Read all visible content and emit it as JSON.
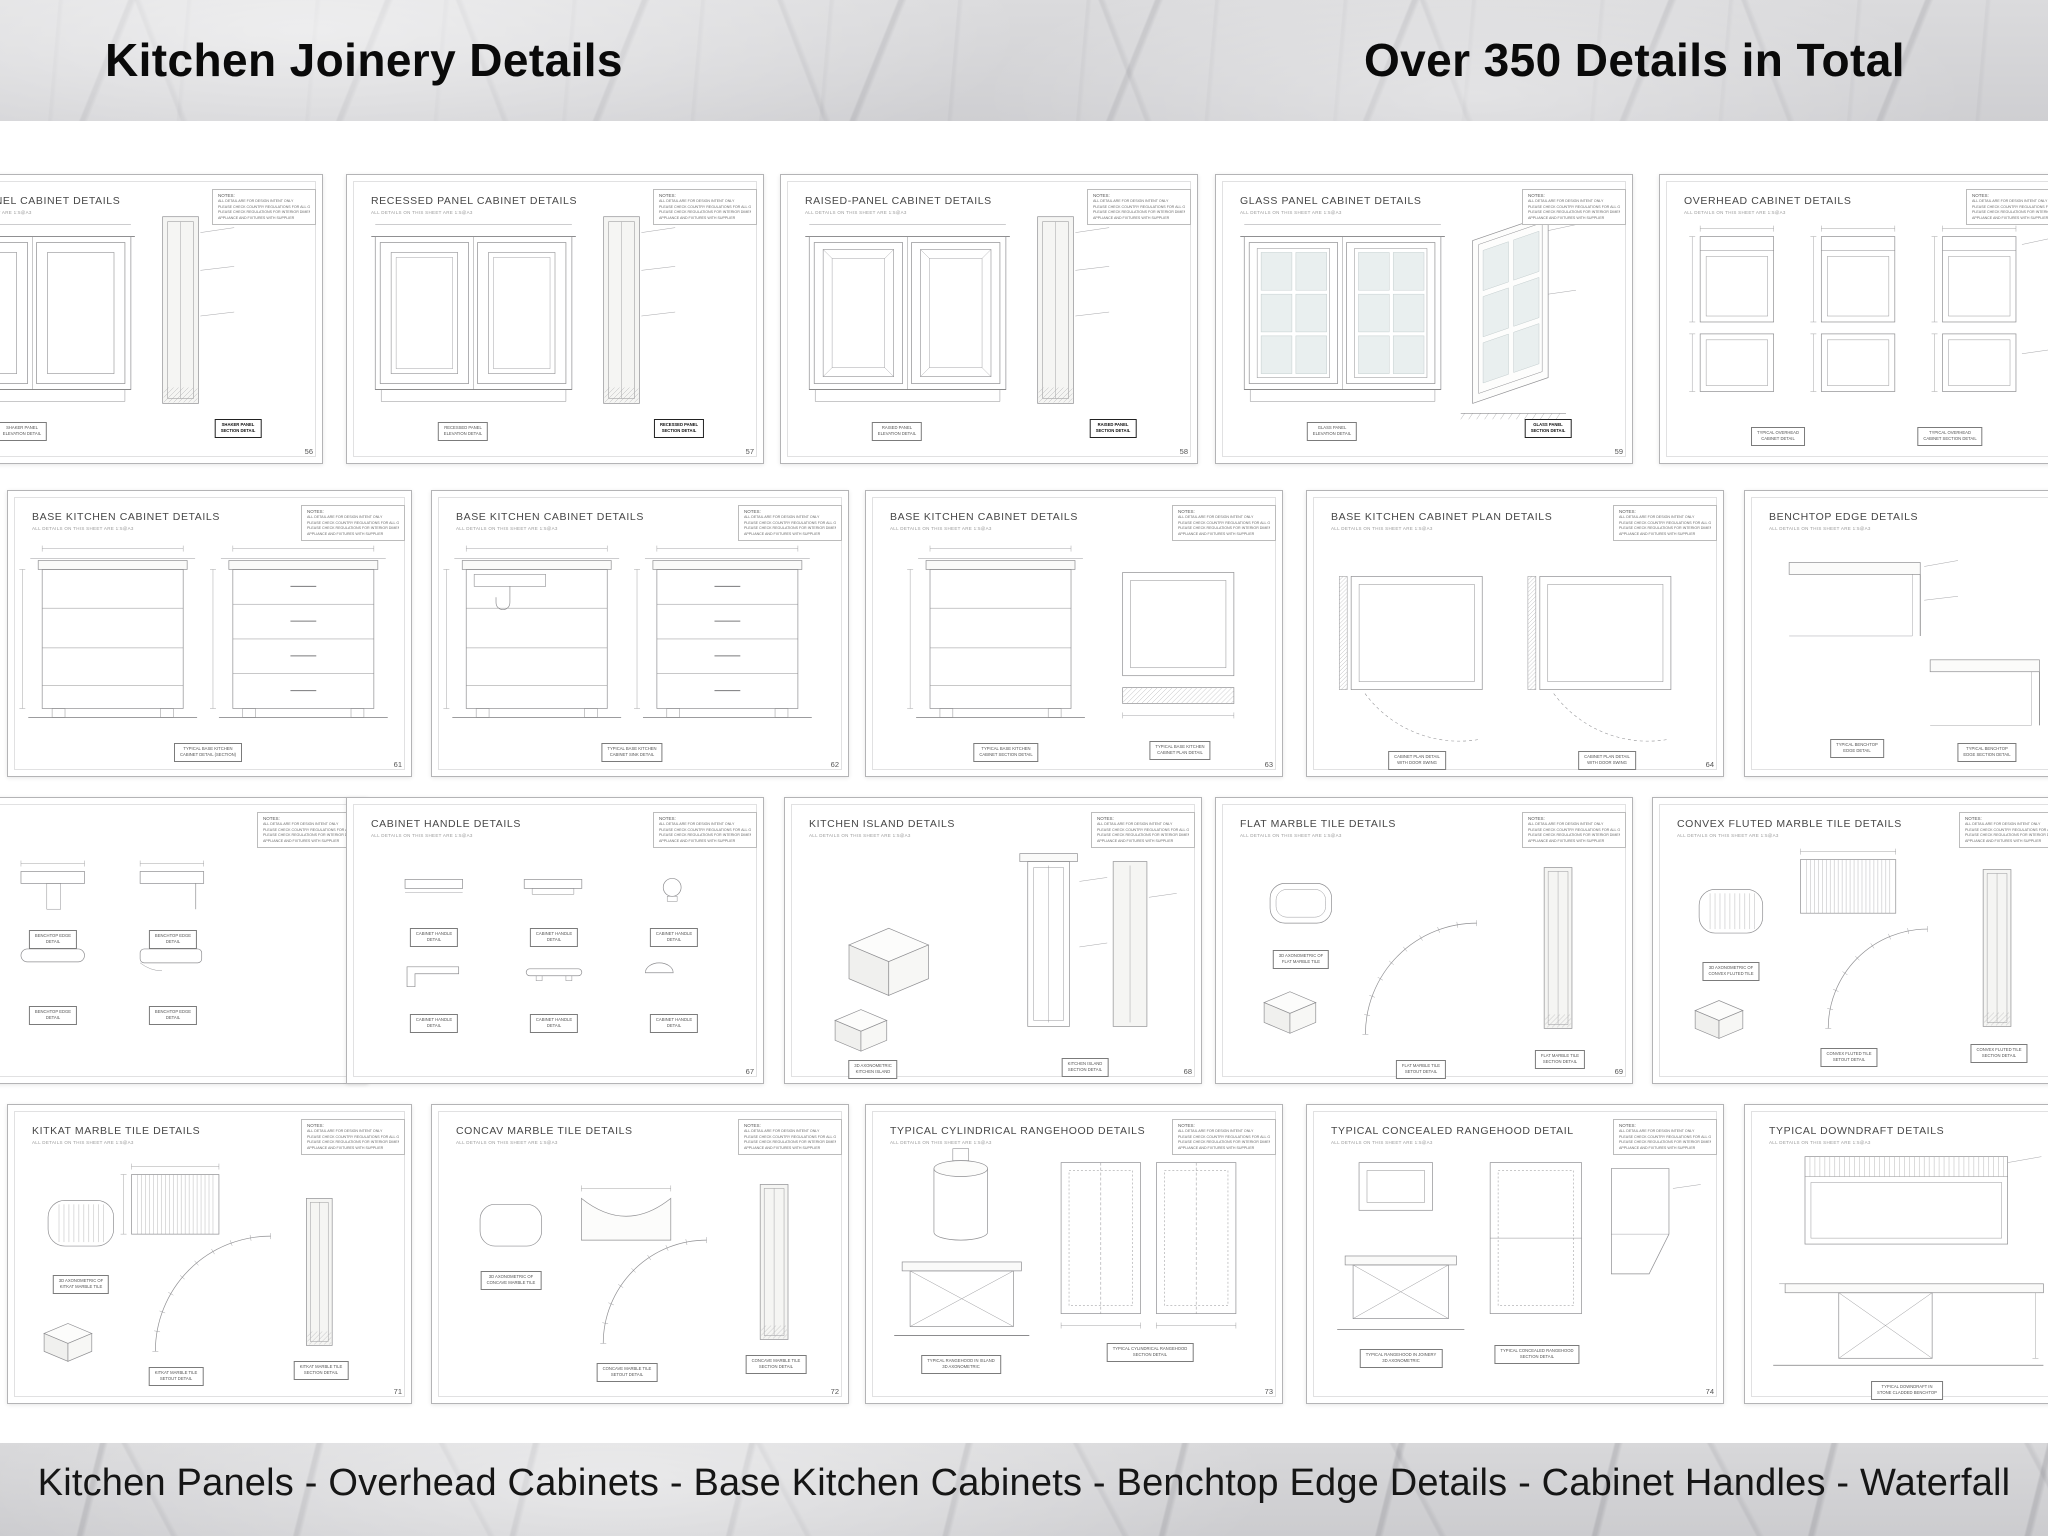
{
  "header": {
    "title_left": "Kitchen Joinery Details",
    "title_right": "Over 350 Details in Total"
  },
  "footer": {
    "caption": "Kitchen Panels - Overhead Cabinets - Base Kitchen Cabinets - Benchtop Edge Details - Cabinet Handles - Waterfall"
  },
  "sheet_common": {
    "subtitle": "ALL DETAILS ON THIS SHEET ARE 1:5@A3",
    "notes_label": "NOTES:",
    "notes_lines": [
      "ALL DETAIL ARE FOR DESIGN INTENT ONLY",
      "PLEASE CHECK COUNTRY REGULATIONS FOR ALL GENERAL BENCHTOP",
      "PLEASE CHECK REGULATIONS FOR INTERIOR DIMENSIONS FOR ALL",
      "APPLIANCE AND FIXTURES WITH SUPPLIER"
    ]
  },
  "colors": {
    "marble_base": "#d8d8da",
    "sheet_border": "#b4b4b6",
    "line": "#8f8f92",
    "glass": "#e9efef",
    "section_fill": "#f5f5f3"
  },
  "sheets": [
    {
      "id": "shaker-panel",
      "title": "SHAKER PANEL CABINET DETAILS",
      "page": "56",
      "kind": "doors",
      "variant": "shaker",
      "x": -95,
      "y": 174,
      "w": 418,
      "h": 290,
      "labels": [
        {
          "l1": "SHAKER PANEL",
          "l2": "ELEVATION DETAIL"
        },
        {
          "l1": "SHAKER PANEL",
          "l2": "SECTION DETAIL",
          "bold": true
        }
      ]
    },
    {
      "id": "recessed-panel",
      "title": "RECESSED PANEL CABINET DETAILS",
      "page": "57",
      "kind": "doors",
      "variant": "recessed",
      "x": 346,
      "y": 174,
      "w": 418,
      "h": 290,
      "labels": [
        {
          "l1": "RECESSED PANEL",
          "l2": "ELEVATION DETAIL"
        },
        {
          "l1": "RECESSED PANEL",
          "l2": "SECTION DETAIL",
          "bold": true
        }
      ]
    },
    {
      "id": "raised-panel",
      "title": "RAISED-PANEL CABINET DETAILS",
      "page": "58",
      "kind": "doors",
      "variant": "raised",
      "x": 780,
      "y": 174,
      "w": 418,
      "h": 290,
      "labels": [
        {
          "l1": "RAISED PANEL",
          "l2": "ELEVATION DETAIL"
        },
        {
          "l1": "RAISED PANEL",
          "l2": "SECTION DETAIL",
          "bold": true
        }
      ]
    },
    {
      "id": "glass-panel",
      "title": "GLASS PANEL CABINET DETAILS",
      "page": "59",
      "kind": "doors",
      "variant": "glass",
      "x": 1215,
      "y": 174,
      "w": 418,
      "h": 290,
      "labels": [
        {
          "l1": "GLASS PANEL",
          "l2": "ELEVATION DETAIL"
        },
        {
          "l1": "GLASS PANEL",
          "l2": "SECTION DETAIL",
          "bold": true
        }
      ]
    },
    {
      "id": "overhead-cabinet",
      "title": "OVERHEAD CABINET DETAILS",
      "page": "60",
      "kind": "overhead",
      "variant": "",
      "x": 1659,
      "y": 174,
      "w": 418,
      "h": 290,
      "labels": [
        {
          "l1": "TYPICAL OVERHEAD",
          "l2": "CABINET DETAIL"
        },
        {
          "l1": "TYPICAL OVERHEAD",
          "l2": "CABINET SECTION DETAIL"
        }
      ]
    },
    {
      "id": "base-cabinet-1",
      "title": "BASE KITCHEN CABINET DETAILS",
      "page": "61",
      "kind": "base1",
      "variant": "",
      "x": 7,
      "y": 490,
      "w": 405,
      "h": 287,
      "labels": [
        {
          "l1": "TYPICAL BASE KITCHEN",
          "l2": "CABINET DETAIL (SECTION)"
        }
      ]
    },
    {
      "id": "base-cabinet-2",
      "title": "BASE KITCHEN CABINET DETAILS",
      "page": "62",
      "kind": "baseSink",
      "variant": "",
      "x": 431,
      "y": 490,
      "w": 418,
      "h": 287,
      "labels": [
        {
          "l1": "TYPICAL BASE KITCHEN",
          "l2": "CABINET SINK DETAIL"
        }
      ]
    },
    {
      "id": "base-cabinet-3",
      "title": "BASE KITCHEN CABINET DETAILS",
      "page": "63",
      "kind": "basePlan",
      "variant": "",
      "x": 865,
      "y": 490,
      "w": 418,
      "h": 287,
      "labels": [
        {
          "l1": "TYPICAL BASE KITCHEN",
          "l2": "CABINET SECTION DETAIL"
        },
        {
          "l1": "TYPICAL BASE KITCHEN",
          "l2": "CABINET PLAN DETAIL"
        }
      ]
    },
    {
      "id": "base-cabinet-plan",
      "title": "BASE KITCHEN CABINET PLAN DETAILS",
      "page": "64",
      "kind": "plan",
      "variant": "",
      "x": 1306,
      "y": 490,
      "w": 418,
      "h": 287,
      "labels": [
        {
          "l1": "CABINET PLAN DETAIL",
          "l2": "WITH DOOR SWING"
        },
        {
          "l1": "CABINET PLAN DETAIL",
          "l2": "WITH DOOR SWING"
        }
      ]
    },
    {
      "id": "benchtop-edge",
      "title": "BENCHTOP EDGE DETAILS",
      "page": "65",
      "kind": "bench",
      "variant": "",
      "x": 1744,
      "y": 490,
      "w": 418,
      "h": 287,
      "labels": [
        {
          "l1": "TYPICAL BENCHTOP",
          "l2": "EDGE DETAIL"
        },
        {
          "l1": "TYPICAL BENCHTOP",
          "l2": "EDGE SECTION DETAIL"
        }
      ]
    },
    {
      "id": "edge-profiles",
      "title": "",
      "page": "66",
      "kind": "profiles",
      "variant": "",
      "x": -50,
      "y": 797,
      "w": 418,
      "h": 287,
      "labels": [
        {
          "l1": "BENCHTOP EDGE",
          "l2": "DETAIL"
        },
        {
          "l1": "BENCHTOP EDGE",
          "l2": "DETAIL"
        },
        {
          "l1": "BENCHTOP EDGE",
          "l2": "DETAIL"
        },
        {
          "l1": "BENCHTOP EDGE",
          "l2": "DETAIL"
        }
      ]
    },
    {
      "id": "cabinet-handles",
      "title": "CABINET HANDLE DETAILS",
      "page": "67",
      "kind": "handles",
      "variant": "",
      "x": 346,
      "y": 797,
      "w": 418,
      "h": 287,
      "labels": [
        {
          "l1": "CABINET HANDLE",
          "l2": "DETAIL"
        },
        {
          "l1": "CABINET HANDLE",
          "l2": "DETAIL"
        },
        {
          "l1": "CABINET HANDLE",
          "l2": "DETAIL"
        },
        {
          "l1": "CABINET HANDLE",
          "l2": "DETAIL"
        },
        {
          "l1": "CABINET HANDLE",
          "l2": "DETAIL"
        },
        {
          "l1": "CABINET HANDLE",
          "l2": "DETAIL"
        }
      ]
    },
    {
      "id": "kitchen-island",
      "title": "KITCHEN ISLAND DETAILS",
      "page": "68",
      "kind": "island",
      "variant": "",
      "x": 784,
      "y": 797,
      "w": 418,
      "h": 287,
      "labels": [
        {
          "l1": "3D AXONOMETRIC",
          "l2": "KITCHEN ISLAND"
        },
        {
          "l1": "KITCHEN ISLAND",
          "l2": "SECTION DETAIL"
        }
      ]
    },
    {
      "id": "flat-marble-tile",
      "title": "FLAT MARBLE TILE DETAILS",
      "page": "69",
      "kind": "flat",
      "variant": "",
      "x": 1215,
      "y": 797,
      "w": 418,
      "h": 287,
      "labels": [
        {
          "l1": "3D AXONOMETRIC OF",
          "l2": "FLAT MARBLE TILE"
        },
        {
          "l1": "FLAT MARBLE TILE",
          "l2": "SETOUT DETAIL"
        },
        {
          "l1": "FLAT MARBLE TILE",
          "l2": "SECTION DETAIL"
        }
      ]
    },
    {
      "id": "convex-fluted-tile",
      "title": "CONVEX FLUTED MARBLE TILE DETAILS",
      "page": "70",
      "kind": "convex",
      "variant": "",
      "x": 1652,
      "y": 797,
      "w": 418,
      "h": 287,
      "labels": [
        {
          "l1": "3D AXONOMETRIC OF",
          "l2": "CONVEX FLUTED TILE"
        },
        {
          "l1": "CONVEX FLUTED TILE",
          "l2": "SETOUT DETAIL"
        },
        {
          "l1": "CONVEX FLUTED TILE",
          "l2": "SECTION DETAIL"
        }
      ]
    },
    {
      "id": "kitkat-tile",
      "title": "KITKAT MARBLE TILE DETAILS",
      "page": "71",
      "kind": "kitkat",
      "variant": "",
      "x": 7,
      "y": 1104,
      "w": 405,
      "h": 300,
      "labels": [
        {
          "l1": "3D AXONOMETRIC OF",
          "l2": "KITKAT MARBLE TILE"
        },
        {
          "l1": "KITKAT MARBLE TILE",
          "l2": "SETOUT DETAIL"
        },
        {
          "l1": "KITKAT MARBLE TILE",
          "l2": "SECTION DETAIL"
        }
      ]
    },
    {
      "id": "concav-tile",
      "title": "CONCAV MARBLE TILE DETAILS",
      "page": "72",
      "kind": "concav",
      "variant": "",
      "x": 431,
      "y": 1104,
      "w": 418,
      "h": 300,
      "labels": [
        {
          "l1": "3D AXONOMETRIC OF",
          "l2": "CONCAVE MARBLE TILE"
        },
        {
          "l1": "CONCAVE MARBLE TILE",
          "l2": "SETOUT DETAIL"
        },
        {
          "l1": "CONCAVE MARBLE TILE",
          "l2": "SECTION DETAIL"
        }
      ]
    },
    {
      "id": "cylindrical-rangehood",
      "title": "TYPICAL CYLINDRICAL RANGEHOOD DETAILS",
      "page": "73",
      "kind": "cyl",
      "variant": "",
      "x": 865,
      "y": 1104,
      "w": 418,
      "h": 300,
      "labels": [
        {
          "l1": "TYPICAL RANGEHOOD IN ISLAND",
          "l2": "3D AXONOMETRIC"
        },
        {
          "l1": "TYPICAL CYLINDRICAL RANGEHOOD",
          "l2": "SECTION DETAIL"
        }
      ]
    },
    {
      "id": "concealed-rangehood",
      "title": "TYPICAL CONCEALED RANGEHOOD DETAIL",
      "page": "74",
      "kind": "conc",
      "variant": "",
      "x": 1306,
      "y": 1104,
      "w": 418,
      "h": 300,
      "labels": [
        {
          "l1": "TYPICAL RANGEHOOD IN JOINERY",
          "l2": "3D AXONOMETRIC"
        },
        {
          "l1": "TYPICAL CONCEALED RANGEHOOD",
          "l2": "SECTION DETAIL"
        }
      ]
    },
    {
      "id": "downdraft",
      "title": "TYPICAL DOWNDRAFT DETAILS",
      "page": "75",
      "kind": "down",
      "variant": "",
      "x": 1744,
      "y": 1104,
      "w": 418,
      "h": 300,
      "labels": [
        {
          "l1": "TYPICAL DOWNDRAFT IN",
          "l2": "STONE CLADDED BENCHTOP"
        }
      ]
    }
  ]
}
